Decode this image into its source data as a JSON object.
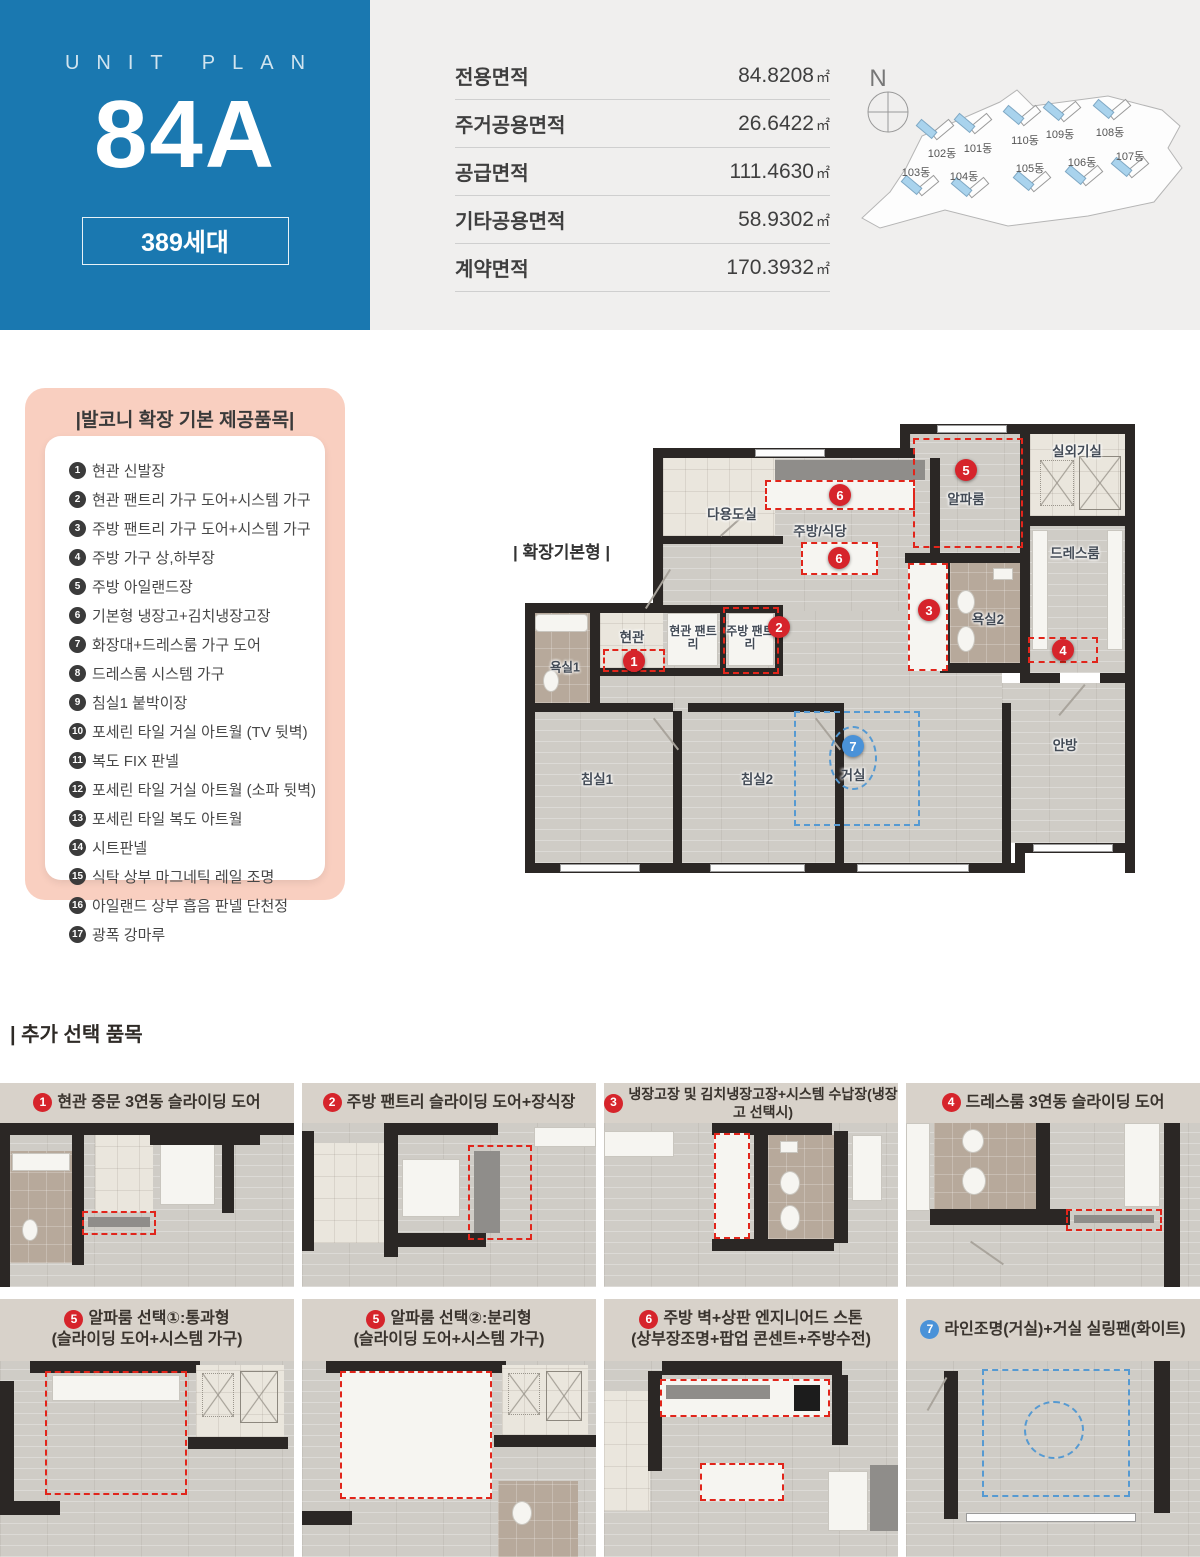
{
  "header": {
    "unit_plan_label": "UNIT PLAN",
    "unit_code": "84A",
    "households_badge": "389세대",
    "site_map": {
      "compass": "N",
      "buildings": [
        "102동",
        "101동",
        "110동",
        "109동",
        "108동",
        "103동",
        "104동",
        "105동",
        "106동",
        "107동"
      ]
    }
  },
  "area": {
    "rows": [
      {
        "label": "전용면적",
        "value": "84.8208",
        "unit": "㎡"
      },
      {
        "label": "주거공용면적",
        "value": "26.6422",
        "unit": "㎡"
      },
      {
        "label": "공급면적",
        "value": "111.4630",
        "unit": "㎡"
      },
      {
        "label": "기타공용면적",
        "value": "58.9302",
        "unit": "㎡"
      },
      {
        "label": "계약면적",
        "value": "170.3932",
        "unit": "㎡"
      }
    ]
  },
  "balcony": {
    "title": "|발코니 확장 기본 제공품목|",
    "items": [
      {
        "num": "1",
        "text": "현관 신발장"
      },
      {
        "num": "2",
        "text": "현관 팬트리 가구 도어+시스템 가구"
      },
      {
        "num": "3",
        "text": "주방 팬트리 가구 도어+시스템 가구"
      },
      {
        "num": "4",
        "text": "주방 가구 상,하부장"
      },
      {
        "num": "5",
        "text": "주방 아일랜드장"
      },
      {
        "num": "6",
        "text": "기본형 냉장고+김치냉장고장"
      },
      {
        "num": "7",
        "text": "화장대+드레스룸 가구 도어"
      },
      {
        "num": "8",
        "text": "드레스룸 시스템 가구"
      },
      {
        "num": "9",
        "text": "침실1 붙박이장"
      },
      {
        "num": "10",
        "text": "포세린 타일 거실 아트월 (TV 뒷벽)"
      },
      {
        "num": "11",
        "text": "복도 FIX 판넬"
      },
      {
        "num": "12",
        "text": "포세린 타일 거실 아트월 (소파 뒷벽)"
      },
      {
        "num": "13",
        "text": "포세린 타일 복도 아트월"
      },
      {
        "num": "14",
        "text": "시트판넬"
      },
      {
        "num": "15",
        "text": "식탁 상부 마그네틱 레일 조명"
      },
      {
        "num": "16",
        "text": "아일랜드 상부 흡음 판넬 단천정"
      },
      {
        "num": "17",
        "text": "광폭 강마루"
      }
    ]
  },
  "floor_plan": {
    "variant_label": "| 확장기본형 |",
    "rooms": [
      "다용도실",
      "주방/식당",
      "알파룸",
      "실외기실",
      "드레스룸",
      "욕실2",
      "현관",
      "현관 팬트리",
      "주방 팬트리",
      "욕실1",
      "침실1",
      "침실2",
      "거실",
      "안방"
    ],
    "markers": [
      "1",
      "2",
      "3",
      "4",
      "5",
      "6",
      "6",
      "7"
    ]
  },
  "options": {
    "title": "| 추가 선택 품목",
    "cards": [
      {
        "num": "1",
        "accent": "red",
        "title": "현관 중문 3연동 슬라이딩 도어",
        "subtitle": ""
      },
      {
        "num": "2",
        "accent": "red",
        "title": "주방 팬트리 슬라이딩 도어+장식장",
        "subtitle": ""
      },
      {
        "num": "3",
        "accent": "red",
        "title": "냉장고장 및 김치냉장고장+시스템 수납장(냉장고 선택시)",
        "subtitle": ""
      },
      {
        "num": "4",
        "accent": "red",
        "title": "드레스룸 3연동 슬라이딩 도어",
        "subtitle": ""
      },
      {
        "num": "5",
        "accent": "red",
        "title": "알파룸 선택①:통과형",
        "subtitle": "(슬라이딩 도어+시스템 가구)"
      },
      {
        "num": "5",
        "accent": "red",
        "title": "알파룸 선택②:분리형",
        "subtitle": "(슬라이딩 도어+시스템 가구)"
      },
      {
        "num": "6",
        "accent": "red",
        "title": "주방 벽+상판 엔지니어드 스톤",
        "subtitle": "(상부장조명+팝업 콘센트+주방수전)"
      },
      {
        "num": "7",
        "accent": "blue",
        "title": "라인조명(거실)+거실 실링팬(화이트)",
        "subtitle": ""
      }
    ]
  }
}
